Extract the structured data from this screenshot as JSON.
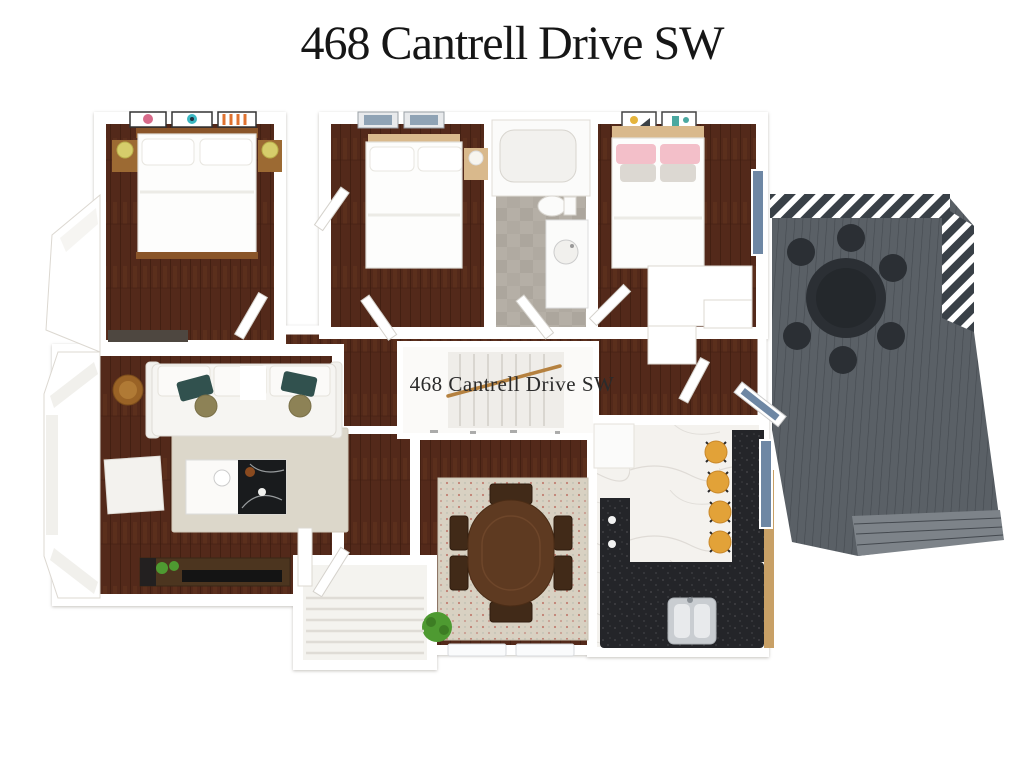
{
  "page": {
    "title": "468 Cantrell Drive SW",
    "watermark": "468 Cantrell Drive SW"
  },
  "theme": {
    "page_bg": "#ffffff",
    "title_color": "#161616",
    "wood_floor": "#53291a",
    "wood_plank_line": "#3f1d0f",
    "wood_streak": "#6f3c22",
    "wall_white": "#ffffff",
    "wall_edge": "#dcd8d1",
    "deck_base": "#5a6066",
    "deck_line": "#44494f",
    "deck_steps": "#7d8389",
    "pergola_dark": "#394047",
    "tile_gray": "#b5afa6",
    "marble_white": "#f4f2ee",
    "marble_vein": "#d9d6d0",
    "counter_black": "#242529",
    "cabinet_tan": "#c8a066",
    "stool_yellow": "#e2a238",
    "lamp_yellow": "#d6cd6b",
    "pillow_pink": "#f3bfc9",
    "pillow_teal": "#31514e",
    "cushion_olive": "#8d8256",
    "rug_living": "#dcd7ca",
    "rug_dining": "#d8d1c2",
    "rug_dining_dot": "#bc6a5f",
    "table_wood": "#5e3a21",
    "chair_wood": "#412a18",
    "sofa_white": "#f6f5f2",
    "bed_white": "#fdfdfc",
    "headboard_oak": "#8a5529",
    "headboard_light": "#d9b98c",
    "plant_green": "#4e9a31",
    "glass_blue": "#6e87a4",
    "handrail_tan": "#b5813f",
    "outdoor_dark": "#2b2f34",
    "watermark_color": "#2b2b2b"
  }
}
